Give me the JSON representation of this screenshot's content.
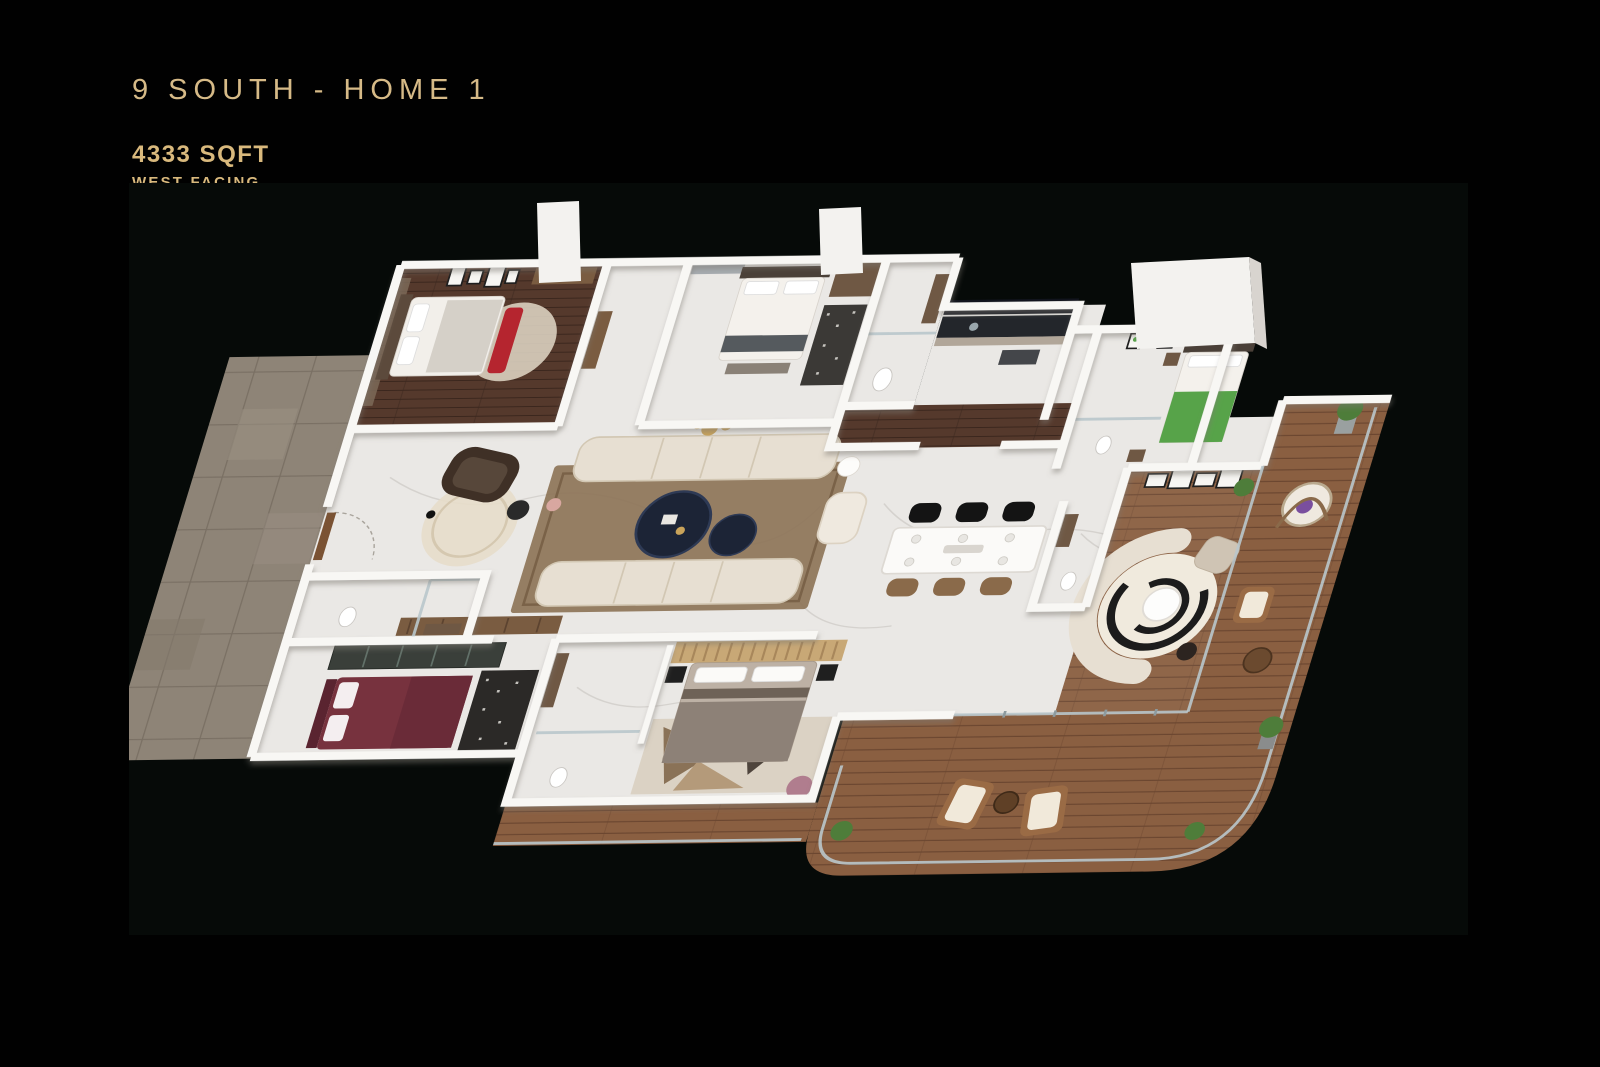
{
  "header": {
    "title": "9 SOUTH - HOME 1",
    "area": "4333 SQFT",
    "facing": "WEST FACING"
  },
  "palette": {
    "pageBg": "#010101",
    "photoBg": "#060a08",
    "gold": "#d6ba87",
    "goldBold": "#d9b97d",
    "marble": "#eae8e5",
    "marbleVein": "#c9c6c2",
    "wall": "#f8f7f4",
    "woodDark": "#55392c",
    "woodDeck": "#8a5f41",
    "deckPlank": "#6b4630",
    "tile": "#8e8477",
    "tileGrout": "#7a7064",
    "sofaCream": "#e7dfd2",
    "navy": "#1c2436",
    "rugBrown": "#8d7458",
    "rugDark": "#2b2927",
    "bedMaroon": "#77323e",
    "bedGray": "#8d8177",
    "bedGreen": "#57a349",
    "glass": "#b9c7cb",
    "plant": "#4e7d3a",
    "cityWindow": "#11141d",
    "accentGold": "#c9a35a"
  }
}
